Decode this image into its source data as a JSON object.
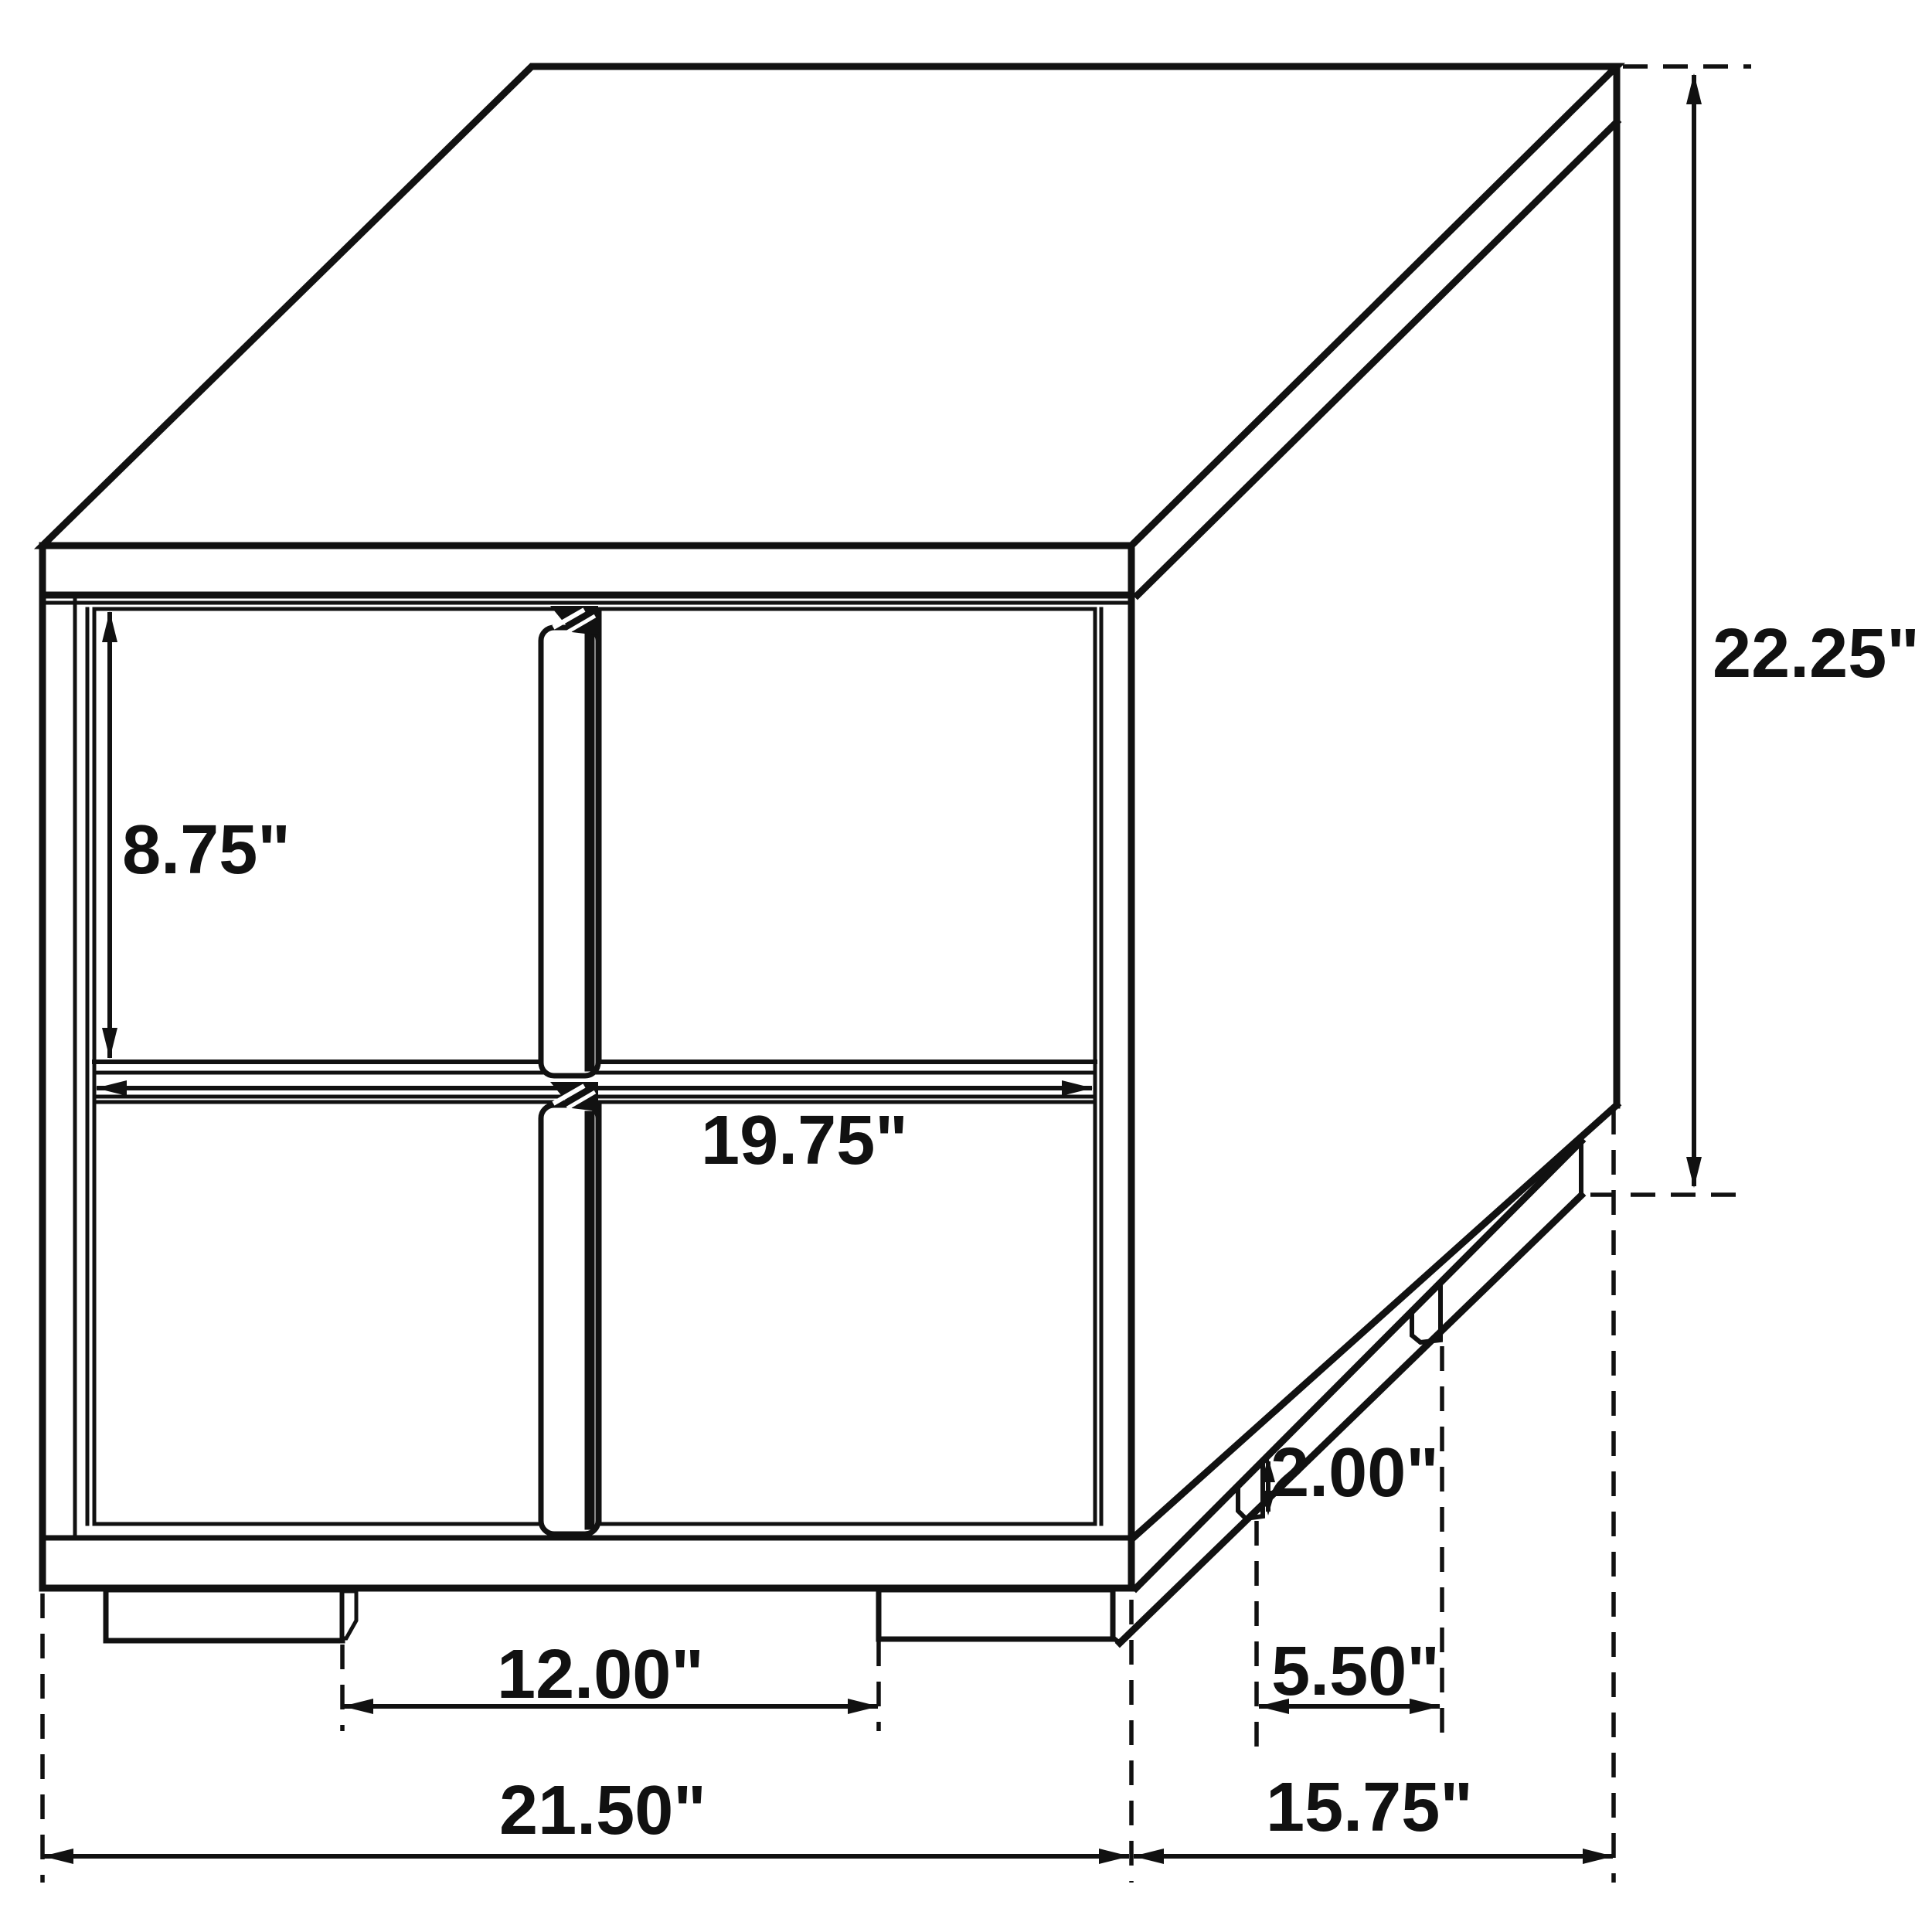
{
  "diagram": {
    "kind": "furniture-dimension-line-drawing",
    "subject": "two-drawer nightstand, isometric view",
    "background": "#ffffff",
    "line_color": "#111111",
    "labels": {
      "height": "22.25\"",
      "drawer_height": "8.75\"",
      "drawer_width": "19.75\"",
      "front_feet_gap": "12.00\"",
      "overall_width": "21.50\"",
      "depth": "15.75\"",
      "side_feet_gap": "5.50\"",
      "foot_height": "2.00\""
    }
  }
}
